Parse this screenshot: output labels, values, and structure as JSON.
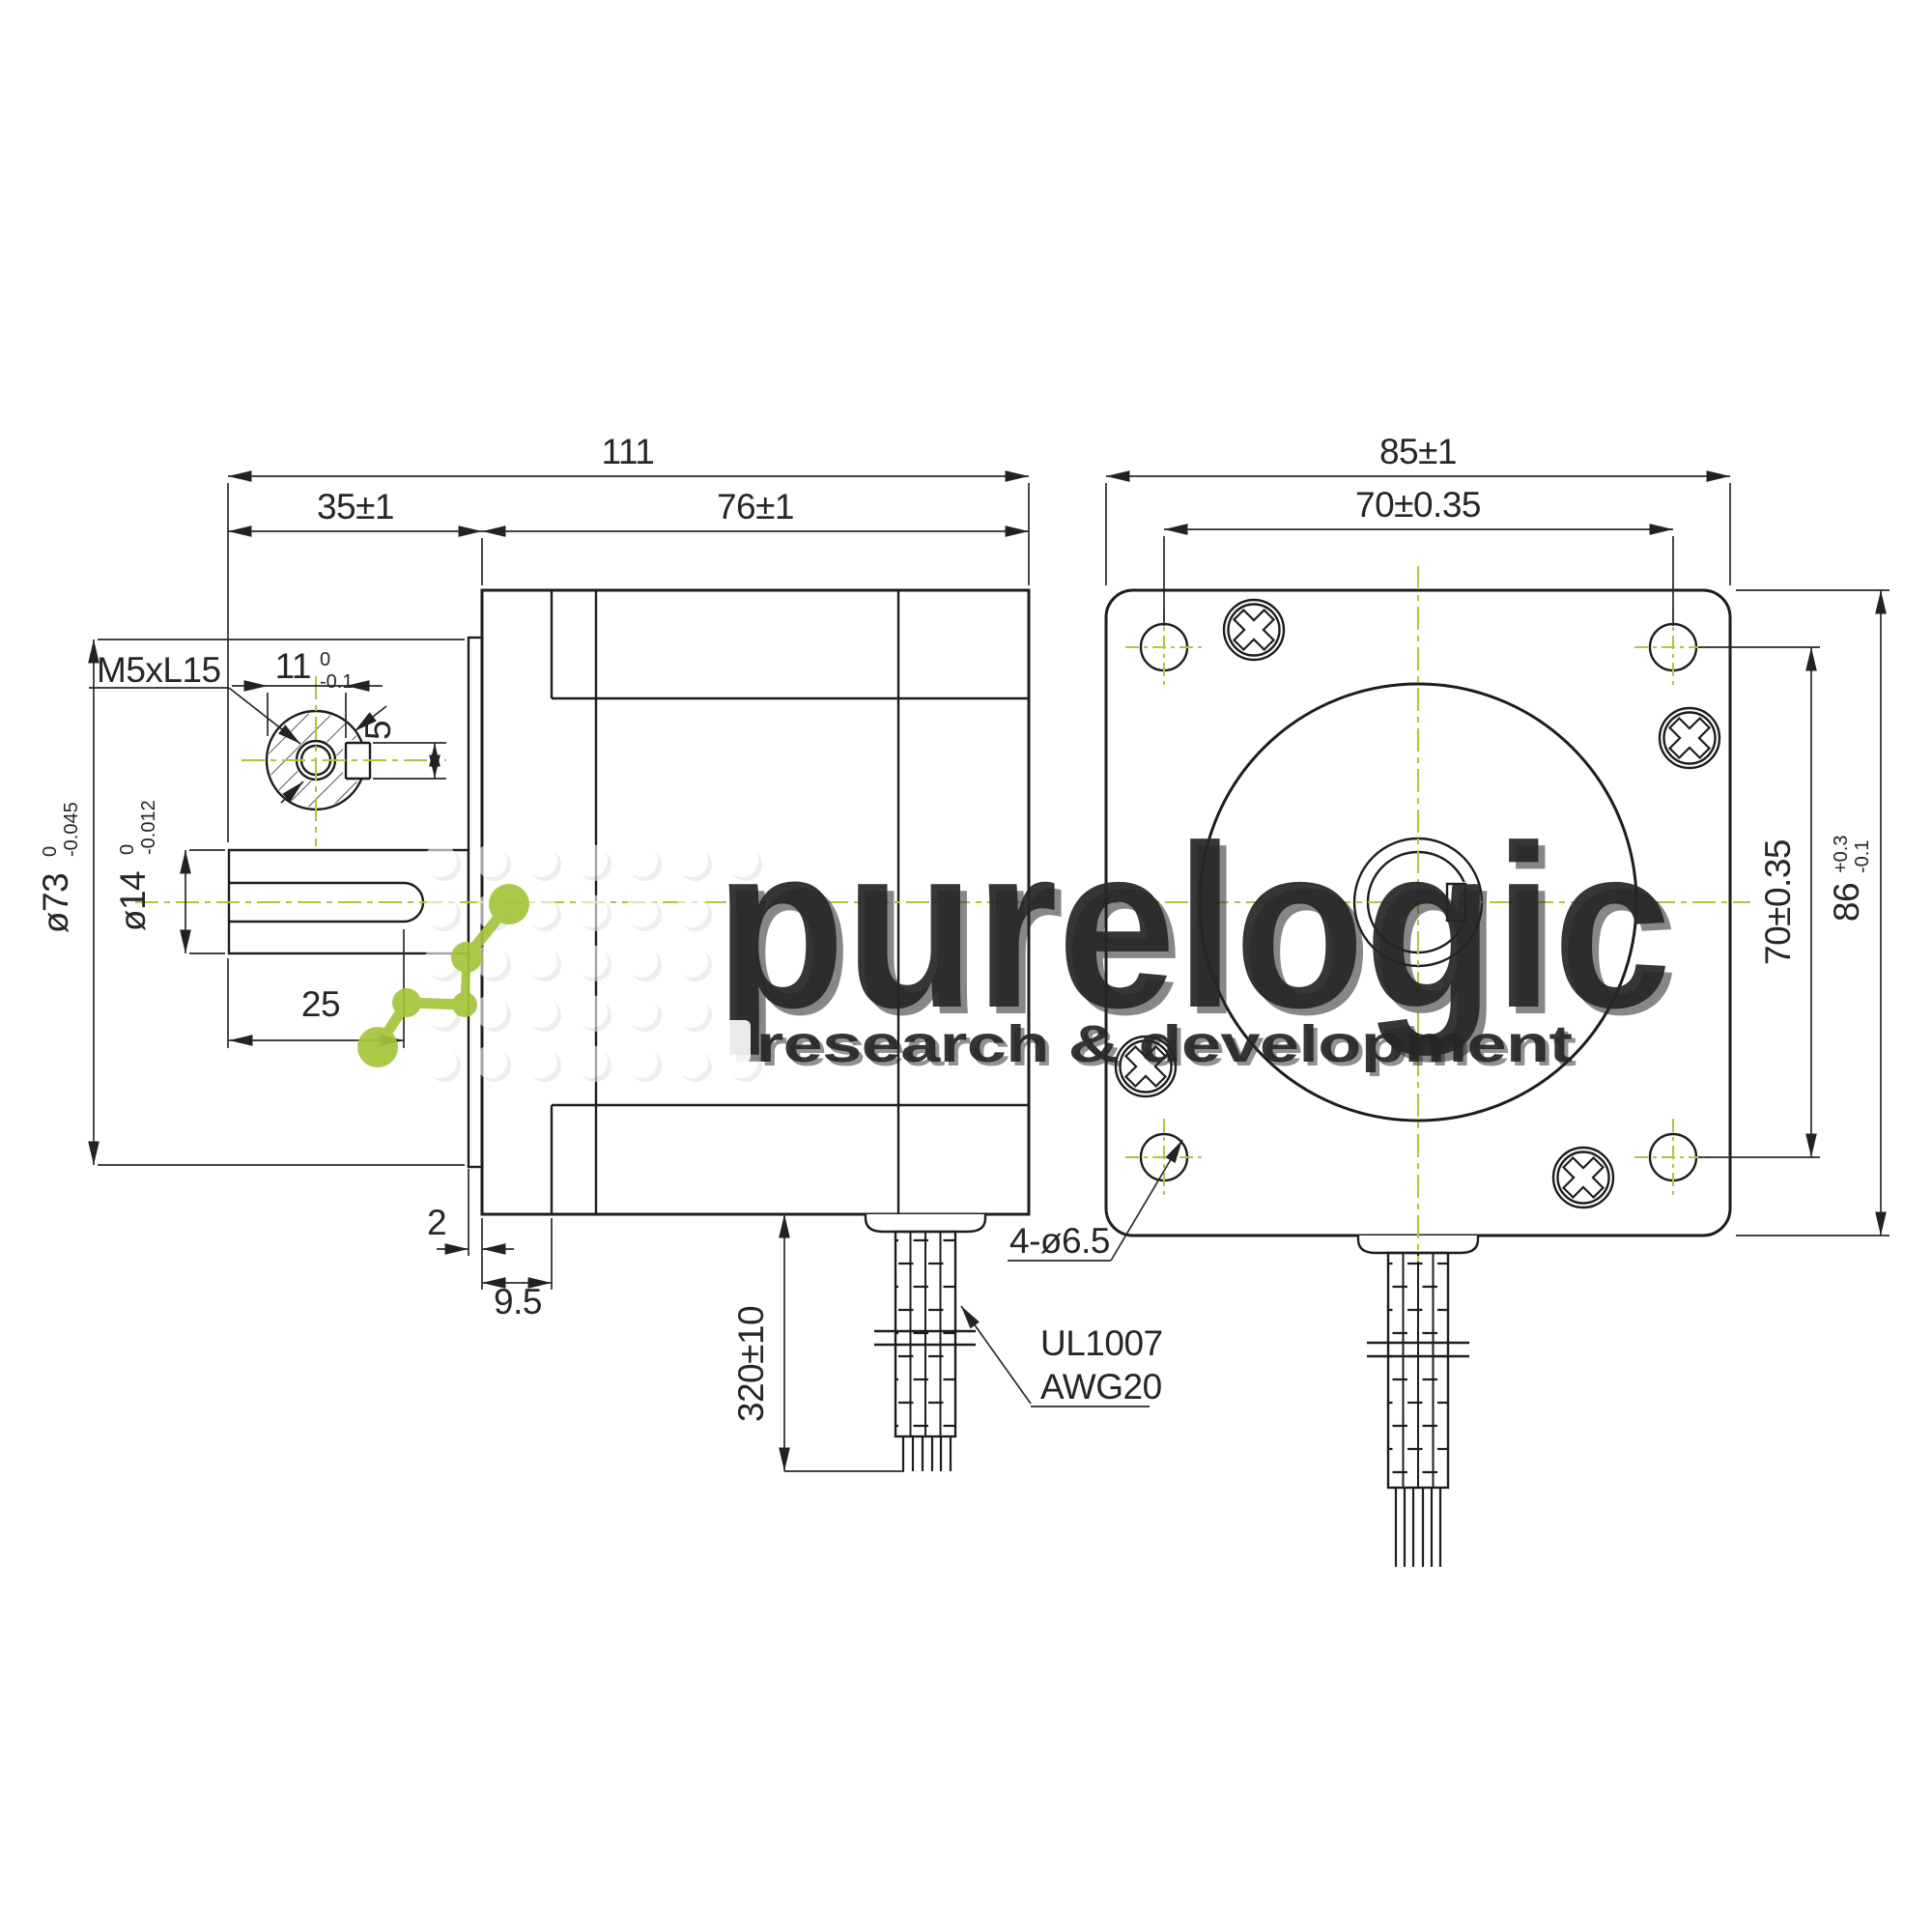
{
  "document": {
    "type": "engineering-dimensional-drawing",
    "subject": "stepper motor, side view and front (flange) view"
  },
  "colors": {
    "line": "#1d1d1d",
    "centerline_green": "#a4cb40",
    "watermark_gray": "#ededed",
    "background": "#ffffff"
  },
  "side_view": {
    "dims": {
      "total_length": "111",
      "front_length": "35±1",
      "body_length": "76±1",
      "key_flat": "11",
      "key_flat_tol_top": "0",
      "key_flat_tol_bot": "-0.1",
      "thread_label": "M5xL15",
      "key_width": "5",
      "shaft_dia": "ø14",
      "shaft_dia_tol_top": "0",
      "shaft_dia_tol_bot": "-0.012",
      "boss_dia": "ø73",
      "boss_dia_tol_top": "0",
      "boss_dia_tol_bot": "-0.045",
      "key_length": "25",
      "boss_thickness": "2",
      "front_step": "9.5",
      "cable_length": "320±10"
    },
    "cable_label_line1": "UL1007",
    "cable_label_line2": "AWG20"
  },
  "front_view": {
    "dims": {
      "body_width": "85±1",
      "hole_spacing_horizontal": "70±0.35",
      "hole_spacing_vertical": "70±0.35",
      "flange_size": "86",
      "flange_tol_top": "+0.3",
      "flange_tol_bot": "-0.1",
      "mounting_holes": "4-ø6.5"
    }
  },
  "watermark": {
    "word": "purelogic",
    "subtitle": "research & development"
  }
}
